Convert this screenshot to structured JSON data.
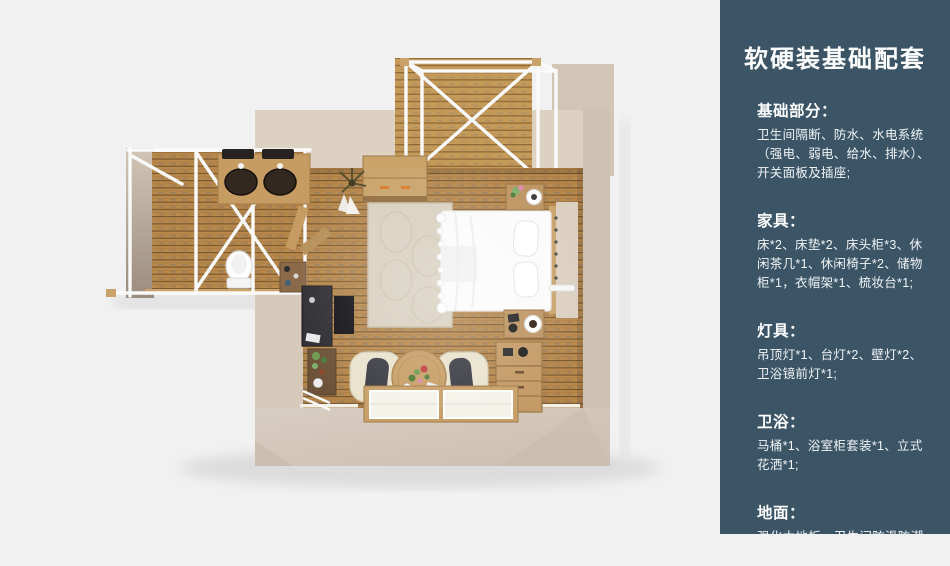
{
  "page": {
    "background": "#f1f1f1"
  },
  "sidebar": {
    "background": "#3b5567",
    "text_color": "#ffffff",
    "title": "软硬装基础配套",
    "sections": [
      {
        "heading": "基础部分：",
        "body": "卫生间隔断、防水、水电系统（强电、弱电、给水、排水）、开关面板及插座;"
      },
      {
        "heading": "家具：",
        "body": "床*2、床垫*2、床头柜*3、休闲茶几*1、休闲椅子*2、储物柜*1，衣帽架*1、梳妆台*1;"
      },
      {
        "heading": "灯具：",
        "body": "吊顶灯*1、台灯*2、壁灯*2、卫浴镜前灯*1;"
      },
      {
        "heading": "卫浴：",
        "body": "马桶*1、浴室柜套装*1、立式花洒*1;"
      },
      {
        "heading": "地面：",
        "body": "强化木地板、卫生间防滑防潮石塑板;"
      }
    ]
  },
  "floorplan": {
    "type": "top-down 3D room render",
    "elements": [
      "terrace-canopy",
      "wood-deck",
      "bathroom-wing",
      "double-sink-vanity",
      "toilet",
      "storage-shelf",
      "coat-rack",
      "storage-cabinet",
      "potted-plant",
      "area-rug",
      "double-bed",
      "nightstand-lamp",
      "nightstand-mug",
      "wall-lamp",
      "tv-console",
      "ladder-shelf",
      "lounge-chair-left",
      "lounge-chair-right",
      "round-coffee-table",
      "wardrobe",
      "floor-windows"
    ],
    "colors": {
      "wall": "#d7cabb",
      "wall_light": "#ddd1c2",
      "wall_dark": "#cfc2b3",
      "wood_floor": "#b9894c",
      "wood_deck": "#c59a59",
      "frame_white": "#fafafa",
      "furniture_wood": "#c9a36a",
      "bed_white": "#fbfbfb"
    }
  }
}
